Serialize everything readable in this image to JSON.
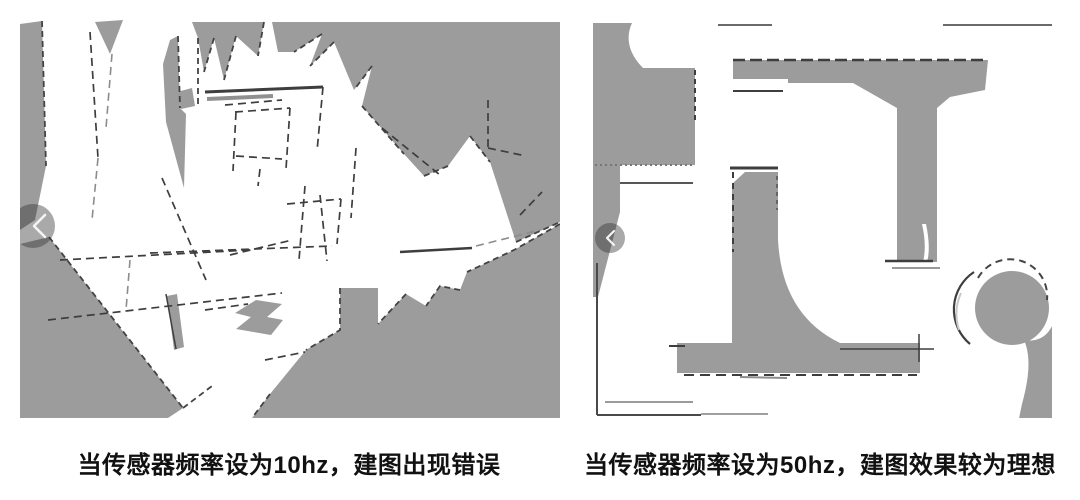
{
  "page": {
    "background": "#ffffff"
  },
  "figures": {
    "left": {
      "id": "map-10hz",
      "caption": "当传感器频率设为10hz，建图出现错误",
      "nav_icon": "chevron-left-icon"
    },
    "right": {
      "id": "map-50hz",
      "caption": "当传感器频率设为50hz，建图效果较为理想",
      "nav_icon": "chevron-left-icon"
    }
  },
  "colors": {
    "map_gray": "#9c9c9c",
    "wall_line": "#3e3e3e",
    "nav_button_overlay": "rgba(50,50,50,0.42)",
    "caption_text": "#111111"
  }
}
